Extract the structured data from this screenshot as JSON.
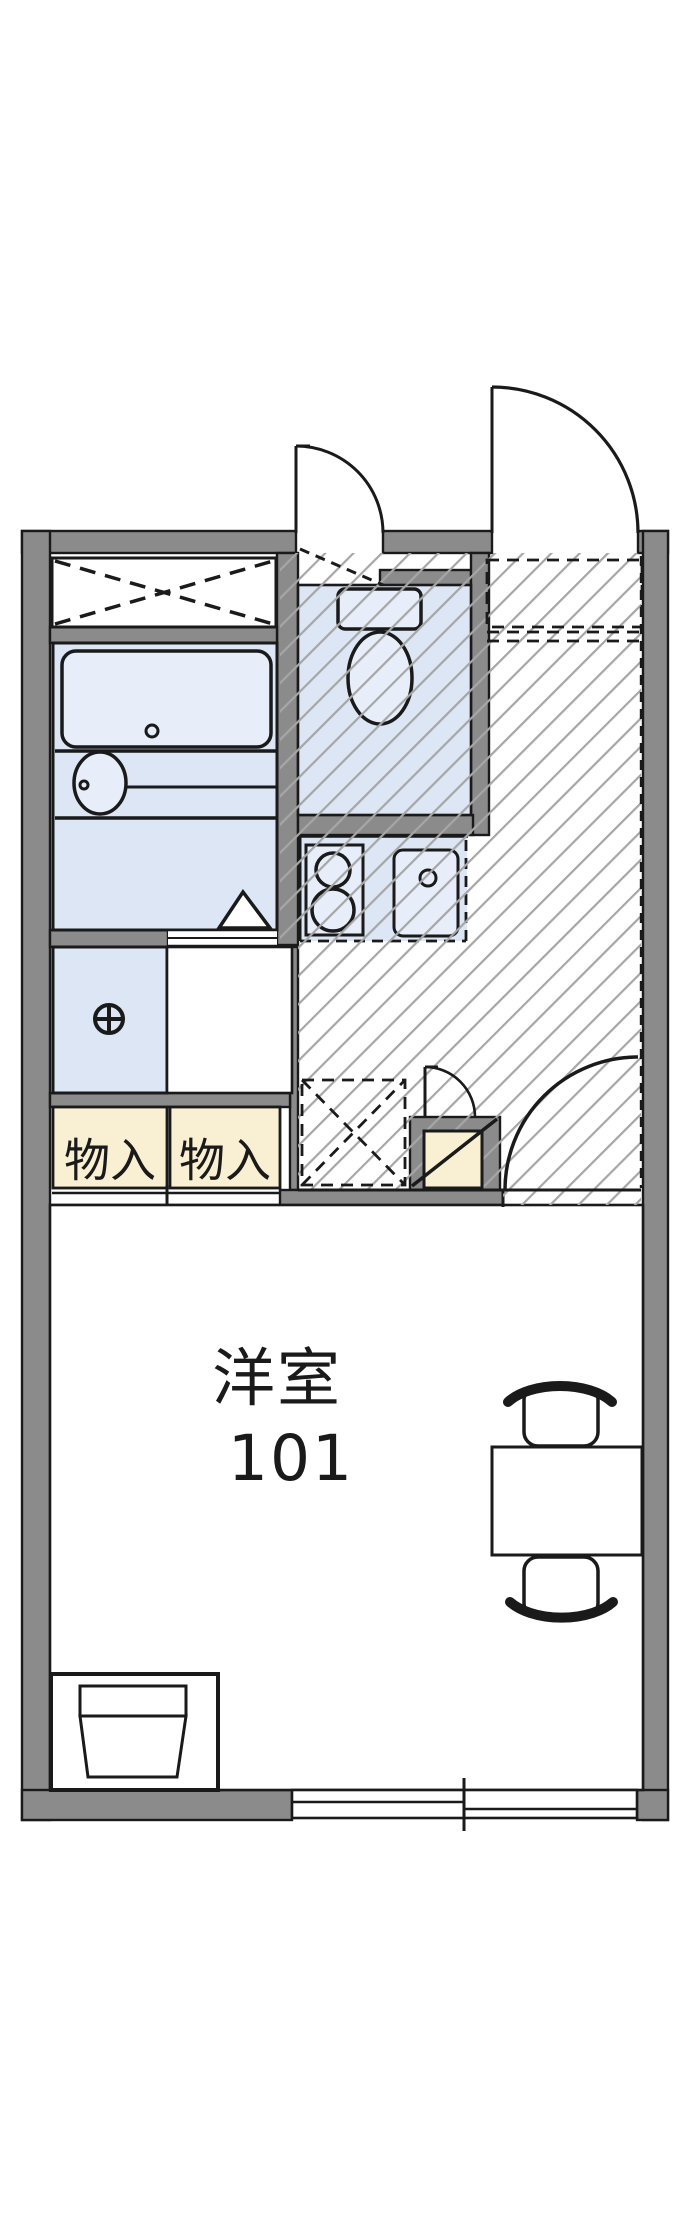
{
  "floorplan": {
    "title": "apartment-floor-plan",
    "main_room": {
      "room_type": "洋室",
      "room_number": "101"
    },
    "closets": [
      {
        "label": "物入"
      },
      {
        "label": "物入"
      }
    ],
    "fixtures": [
      "bathtub",
      "washbasin",
      "toilet",
      "gas-stove",
      "kitchen-sink",
      "washing-machine-tap",
      "storage-cross-box",
      "refrigerator-space",
      "shoe-cabinet",
      "entrance-door",
      "toilet-door",
      "room-door",
      "table",
      "chair",
      "chair",
      "tv-stand",
      "sliding-window",
      "closet-sliding-doors"
    ],
    "colors": {
      "background": "#ffffff",
      "wall_gray": "#8b8b8b",
      "room_blue": "#dce6f4",
      "fixture_blue": "#e7eefa",
      "closet_cream": "#f9efd2",
      "hatch_gray": "#a6a6a6",
      "line_black": "#1a1a1a"
    }
  }
}
